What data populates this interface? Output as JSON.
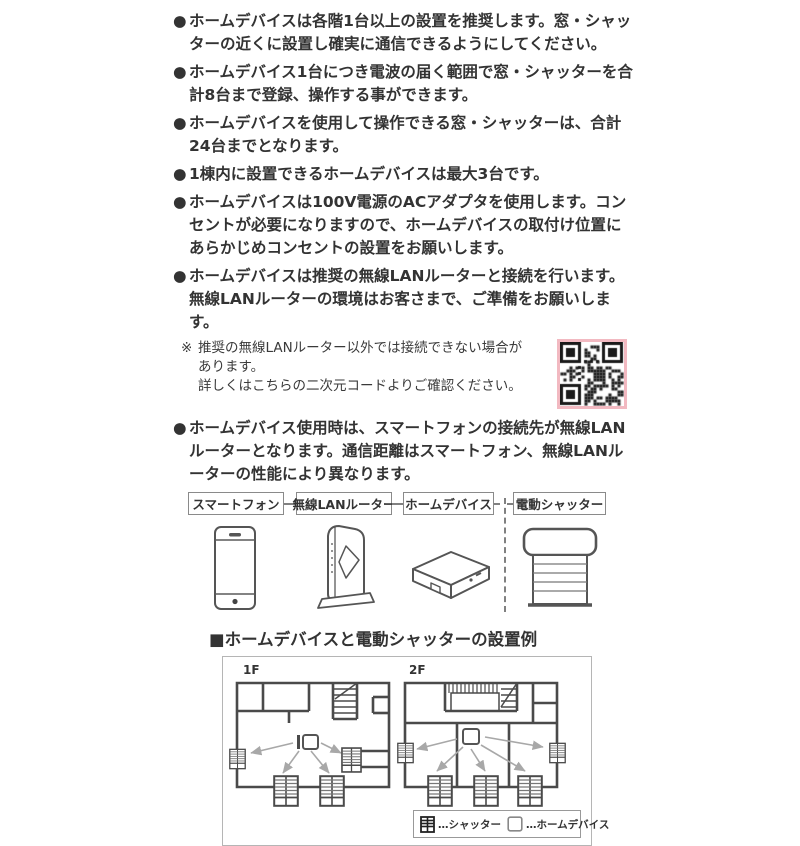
{
  "page": {
    "bullet_marker": "●",
    "bullets": [
      "ホームデバイスは各階1台以上の設置を推奨します。窓・シャッターの近くに設置し確実に通信できるようにしてください。",
      "ホームデバイス1台につき電波の届く範囲で窓・シャッターを合計8台まで登録、操作する事ができます。",
      "ホームデバイスを使用して操作できる窓・シャッターは、合計24台までとなります。",
      "1棟内に設置できるホームデバイスは最大3台です。",
      "ホームデバイスは100V電源のACアダプタを使用します。コンセントが必要になりますので、ホームデバイスの取付け位置にあらかじめコンセントの設置をお願いします。",
      "ホームデバイスは推奨の無線LANルーターと接続を行います。無線LANルーターの環境はお客さまで、ご準備をお願いします。",
      "ホームデバイス使用時は、スマートフォンの接続先が無線LANルーターとなります。通信距離はスマートフォン、無線LANルーターの性能により異なります。"
    ],
    "note": {
      "marker": "※",
      "lines": [
        "推奨の無線LANルーター以外では接続できない場合が",
        "あります。",
        "詳しくはこちらの二次元コードよりご確認ください。"
      ]
    },
    "flow": {
      "labels": [
        "スマートフォン",
        "無線LANルーター",
        "ホームデバイス",
        "電動シャッター"
      ],
      "icons": [
        "smartphone-icon",
        "wireless-router-icon",
        "home-device-icon",
        "electric-shutter-icon"
      ]
    },
    "installation": {
      "heading": "■ホームデバイスと電動シャッターの設置例",
      "floors": [
        "1F",
        "2F"
      ],
      "legend": [
        {
          "icon": "shutter-plan-icon",
          "label": "…シャッター"
        },
        {
          "icon": "home-device-plan-icon",
          "label": "…ホームデバイス"
        }
      ]
    },
    "qr_icon": "qr-code",
    "colors": {
      "text": "#333333",
      "wall": "#4a4a4a",
      "arrow": "#a8a8a8",
      "qr-border": "#f2b9c1",
      "panel-border": "#b5b5b5",
      "box-border": "#8a8a8a"
    }
  }
}
